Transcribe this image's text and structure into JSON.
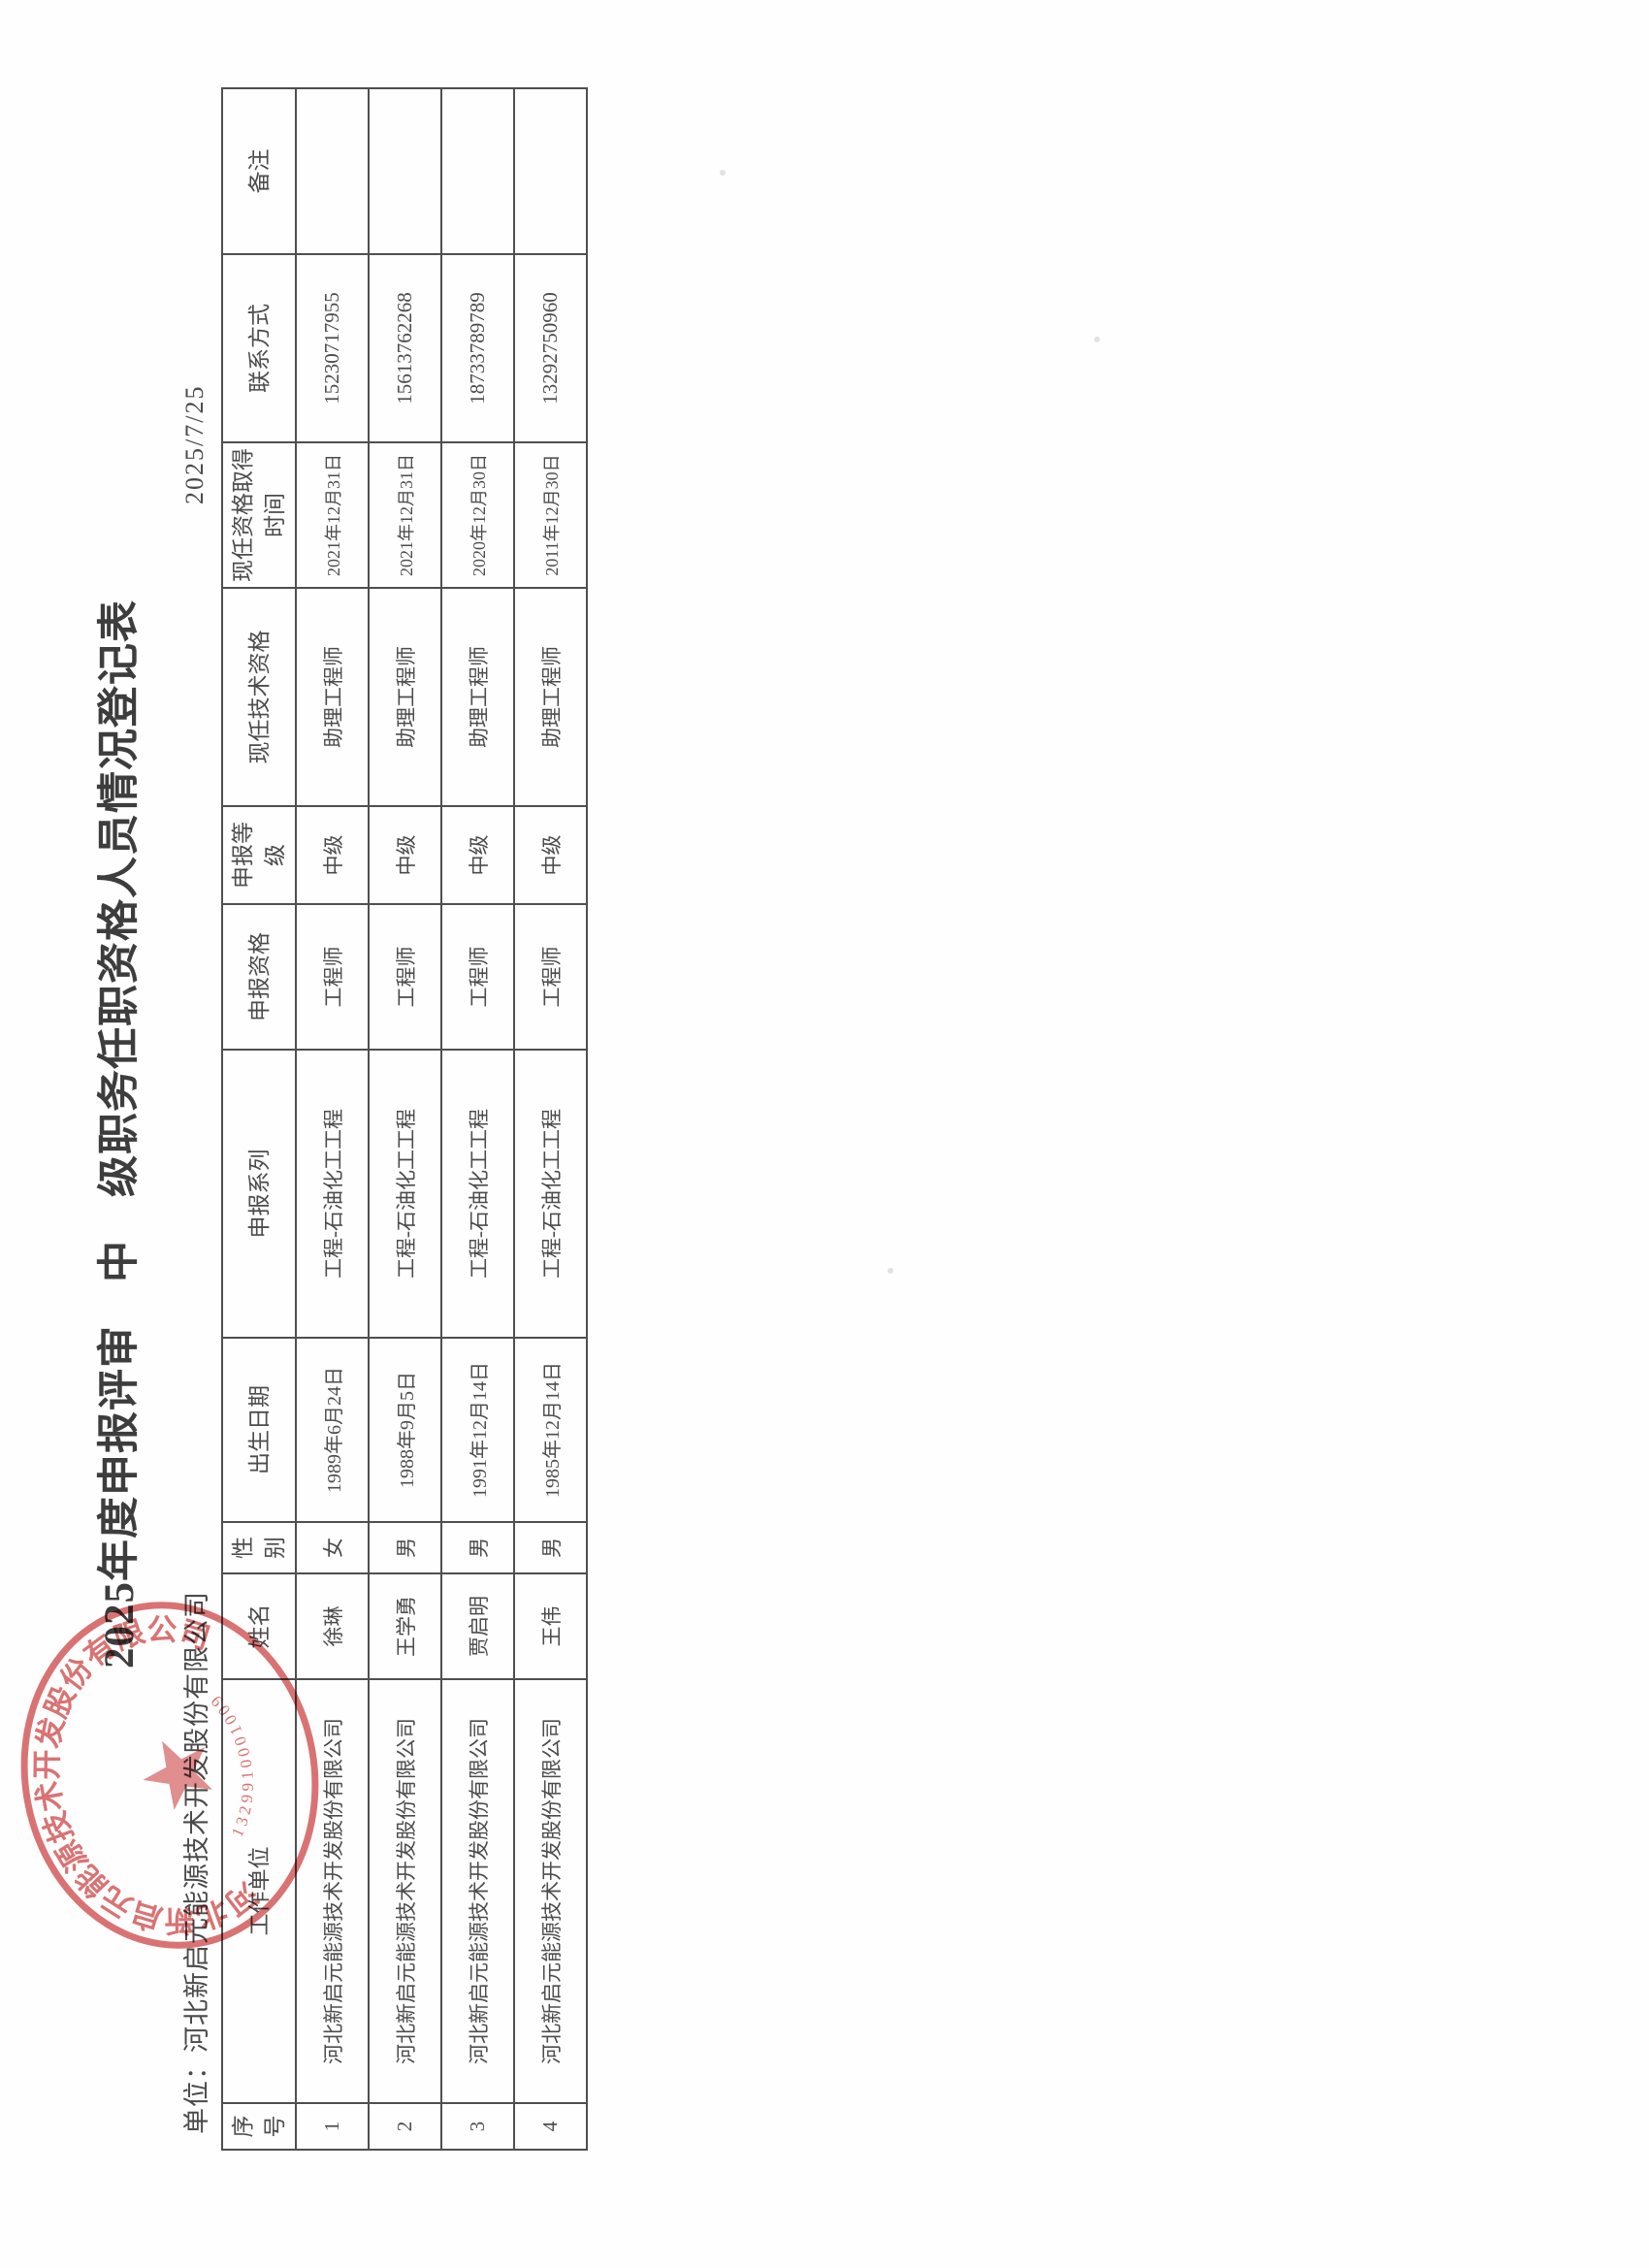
{
  "page": {
    "title": "2025年度申报评审　中　级职务任职资格人员情况登记表",
    "unit_line": "单位：河北新启元能源技术开发股份有限公司",
    "date": "2025/7/25"
  },
  "table": {
    "headers": [
      "序号",
      "工作单位",
      "姓名",
      "性别",
      "出生日期",
      "申报系列",
      "申报资格",
      "申报等级",
      "现任技术资格",
      "现任资格取得时间",
      "联系方式",
      "备注"
    ],
    "rows": [
      [
        "1",
        "河北新启元能源技术开发股份有限公司",
        "徐琳",
        "女",
        "1989年6月24日",
        "工程-石油化工工程",
        "工程师",
        "中级",
        "助理工程师",
        "2021年12月31日",
        "15230717955",
        ""
      ],
      [
        "2",
        "河北新启元能源技术开发股份有限公司",
        "王学勇",
        "男",
        "1988年9月5日",
        "工程-石油化工工程",
        "工程师",
        "中级",
        "助理工程师",
        "2021年12月31日",
        "15613762268",
        ""
      ],
      [
        "3",
        "河北新启元能源技术开发股份有限公司",
        "贾启明",
        "男",
        "1991年12月14日",
        "工程-石油化工工程",
        "工程师",
        "中级",
        "助理工程师",
        "2020年12月30日",
        "18733789789",
        ""
      ],
      [
        "4",
        "河北新启元能源技术开发股份有限公司",
        "王伟",
        "男",
        "1985年12月14日",
        "工程-石油化工工程",
        "工程师",
        "中级",
        "助理工程师",
        "2011年12月30日",
        "13292750960",
        ""
      ]
    ]
  },
  "seal": {
    "company": "河北新启元能源技术开发股份有限公司",
    "number": "1329910001009",
    "color": "#d55f5f"
  }
}
